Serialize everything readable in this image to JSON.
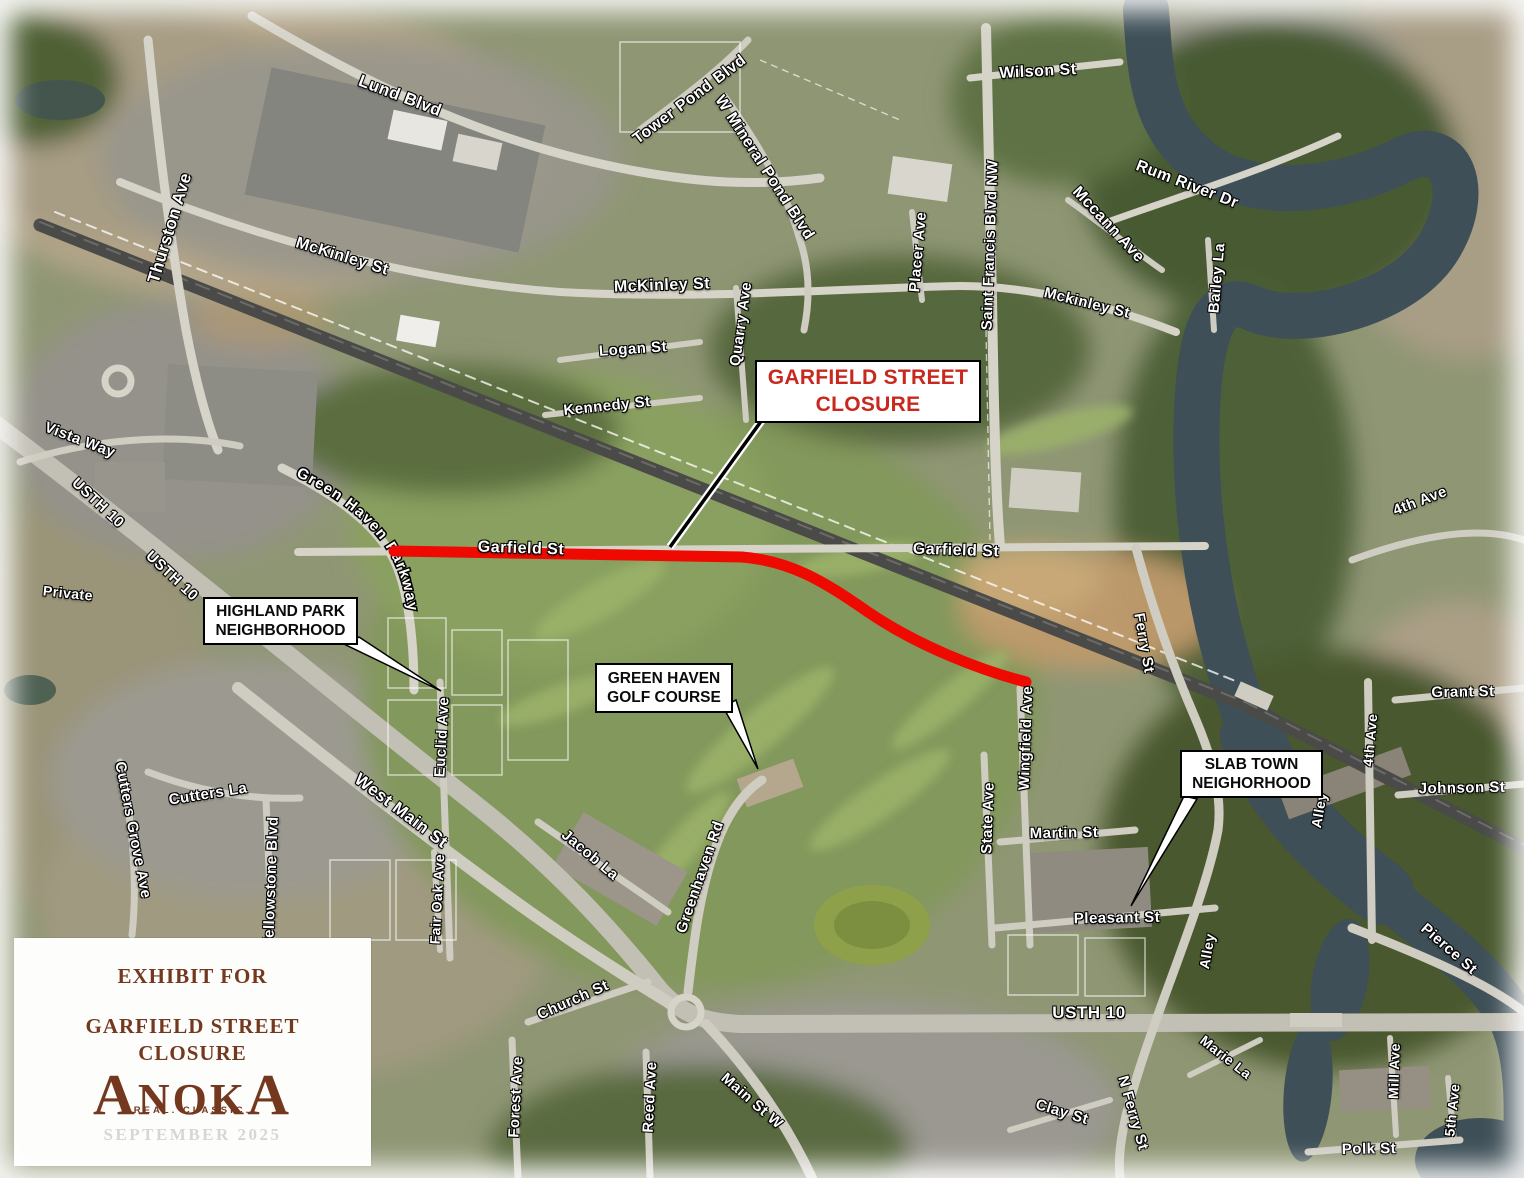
{
  "map": {
    "title": "Exhibit for Garfield Street Closure - aerial map, Anoka MN",
    "colors": {
      "closure_red": "#ee0a00",
      "callout_red": "#c8281e",
      "brown": "#74381f",
      "date_gray": "#d7d6d4",
      "label_white": "#ffffff"
    },
    "callouts": {
      "garfield_closure": {
        "line1": "GARFIELD STREET",
        "line2": "CLOSURE"
      },
      "highland_park": {
        "line1": "HIGHLAND PARK",
        "line2": "NEIGHBORHOOD"
      },
      "green_haven": {
        "line1": "GREEN HAVEN",
        "line2": "GOLF COURSE"
      },
      "slab_town": {
        "line1": "SLAB TOWN",
        "line2": "NEIGHORHOOD"
      }
    },
    "legend": {
      "title_line1": "EXHIBIT FOR",
      "title_line2": "GARFIELD STREET",
      "title_line3": "CLOSURE",
      "logo_text": "ANOKA",
      "logo_tagline": "REAL. CLASSIC.",
      "date": "SEPTEMBER 2025"
    },
    "curved_label": {
      "text": "Green Haven Parkway"
    },
    "street_labels": [
      {
        "text": "Lund Blvd",
        "x": 400,
        "y": 96,
        "rot": 21,
        "size": 17
      },
      {
        "text": "Thurston Ave",
        "x": 170,
        "y": 228,
        "rot": -73,
        "size": 17
      },
      {
        "text": "McKinley St",
        "x": 342,
        "y": 257,
        "rot": 17,
        "size": 16
      },
      {
        "text": "Tower Pond Blvd",
        "x": 690,
        "y": 100,
        "rot": -37,
        "size": 16
      },
      {
        "text": "W Mineral Pond Blvd",
        "x": 764,
        "y": 168,
        "rot": 57,
        "size": 16
      },
      {
        "text": "Wilson St",
        "x": 1038,
        "y": 72,
        "rot": -3,
        "size": 16
      },
      {
        "text": "Rum River Dr",
        "x": 1187,
        "y": 185,
        "rot": 21,
        "size": 16
      },
      {
        "text": "Mccann Ave",
        "x": 1108,
        "y": 225,
        "rot": 47,
        "size": 16
      },
      {
        "text": "Bailey La",
        "x": 1217,
        "y": 278,
        "rot": -85,
        "size": 15
      },
      {
        "text": "Saint Francis Blvd NW",
        "x": 990,
        "y": 245,
        "rot": -88,
        "size": 15
      },
      {
        "text": "Placer Ave",
        "x": 918,
        "y": 252,
        "rot": -85,
        "size": 15
      },
      {
        "text": "McKinley St",
        "x": 662,
        "y": 286,
        "rot": -2,
        "size": 16
      },
      {
        "text": "Mckinley St",
        "x": 1087,
        "y": 303,
        "rot": 14,
        "size": 15
      },
      {
        "text": "Logan St",
        "x": 633,
        "y": 349,
        "rot": -4,
        "size": 15
      },
      {
        "text": "Kennedy St",
        "x": 607,
        "y": 406,
        "rot": -6,
        "size": 15
      },
      {
        "text": "Quarry Ave",
        "x": 741,
        "y": 324,
        "rot": -82,
        "size": 15
      },
      {
        "text": "Vista Way",
        "x": 80,
        "y": 440,
        "rot": 21,
        "size": 15
      },
      {
        "text": "USTH 10",
        "x": 98,
        "y": 503,
        "rot": 43,
        "size": 15
      },
      {
        "text": "USTH 10",
        "x": 172,
        "y": 576,
        "rot": 43,
        "size": 15
      },
      {
        "text": "Private",
        "x": 68,
        "y": 593,
        "rot": 6,
        "size": 14
      },
      {
        "text": "Garfield St",
        "x": 521,
        "y": 549,
        "rot": 2,
        "size": 16
      },
      {
        "text": "Garfield St",
        "x": 956,
        "y": 551,
        "rot": 2,
        "size": 16
      },
      {
        "text": "Euclid Ave",
        "x": 442,
        "y": 737,
        "rot": -87,
        "size": 15
      },
      {
        "text": "Ferry St",
        "x": 1144,
        "y": 643,
        "rot": 80,
        "size": 15
      },
      {
        "text": "Grant St",
        "x": 1463,
        "y": 692,
        "rot": -1,
        "size": 15
      },
      {
        "text": "4th Ave",
        "x": 1420,
        "y": 501,
        "rot": -21,
        "size": 15
      },
      {
        "text": "4th Ave",
        "x": 1370,
        "y": 740,
        "rot": -85,
        "size": 14
      },
      {
        "text": "Johnson St",
        "x": 1462,
        "y": 788,
        "rot": -1,
        "size": 15
      },
      {
        "text": "Wingfield Ave",
        "x": 1026,
        "y": 738,
        "rot": -88,
        "size": 15
      },
      {
        "text": "State Ave",
        "x": 988,
        "y": 818,
        "rot": -88,
        "size": 15
      },
      {
        "text": "Martin St",
        "x": 1064,
        "y": 833,
        "rot": -1,
        "size": 15
      },
      {
        "text": "Cutters La",
        "x": 208,
        "y": 794,
        "rot": -9,
        "size": 15
      },
      {
        "text": "Cutters Grove Ave",
        "x": 133,
        "y": 830,
        "rot": 79,
        "size": 15
      },
      {
        "text": "West Main St",
        "x": 401,
        "y": 811,
        "rot": 37,
        "size": 17
      },
      {
        "text": "Yellowstone Blvd",
        "x": 271,
        "y": 882,
        "rot": -88,
        "size": 15
      },
      {
        "text": "Fair Oak Ave",
        "x": 437,
        "y": 899,
        "rot": -87,
        "size": 14
      },
      {
        "text": "Jacob La",
        "x": 590,
        "y": 855,
        "rot": 40,
        "size": 15
      },
      {
        "text": "Greenhaven Rd",
        "x": 700,
        "y": 877,
        "rot": -71,
        "size": 15
      },
      {
        "text": "Church St",
        "x": 573,
        "y": 1000,
        "rot": -24,
        "size": 15
      },
      {
        "text": "Forest Ave",
        "x": 516,
        "y": 1097,
        "rot": -87,
        "size": 15
      },
      {
        "text": "Reed Ave",
        "x": 650,
        "y": 1097,
        "rot": -87,
        "size": 15
      },
      {
        "text": "Main St W",
        "x": 752,
        "y": 1101,
        "rot": 41,
        "size": 15
      },
      {
        "text": "Pleasant St",
        "x": 1117,
        "y": 918,
        "rot": -1,
        "size": 15
      },
      {
        "text": "Alley",
        "x": 1319,
        "y": 810,
        "rot": -80,
        "size": 14
      },
      {
        "text": "Alley",
        "x": 1207,
        "y": 951,
        "rot": -80,
        "size": 14
      },
      {
        "text": "USTH 10",
        "x": 1089,
        "y": 1013,
        "rot": 0,
        "size": 17
      },
      {
        "text": "Marie La",
        "x": 1226,
        "y": 1057,
        "rot": 38,
        "size": 14
      },
      {
        "text": "Clay St",
        "x": 1062,
        "y": 1112,
        "rot": 17,
        "size": 15
      },
      {
        "text": "N Ferry St",
        "x": 1133,
        "y": 1113,
        "rot": 74,
        "size": 15
      },
      {
        "text": "Mill Ave",
        "x": 1394,
        "y": 1071,
        "rot": -88,
        "size": 14
      },
      {
        "text": "5th Ave",
        "x": 1452,
        "y": 1110,
        "rot": -84,
        "size": 14
      },
      {
        "text": "Polk St",
        "x": 1369,
        "y": 1149,
        "rot": -1,
        "size": 15
      },
      {
        "text": "Pierce St",
        "x": 1449,
        "y": 949,
        "rot": 41,
        "size": 15
      }
    ]
  }
}
